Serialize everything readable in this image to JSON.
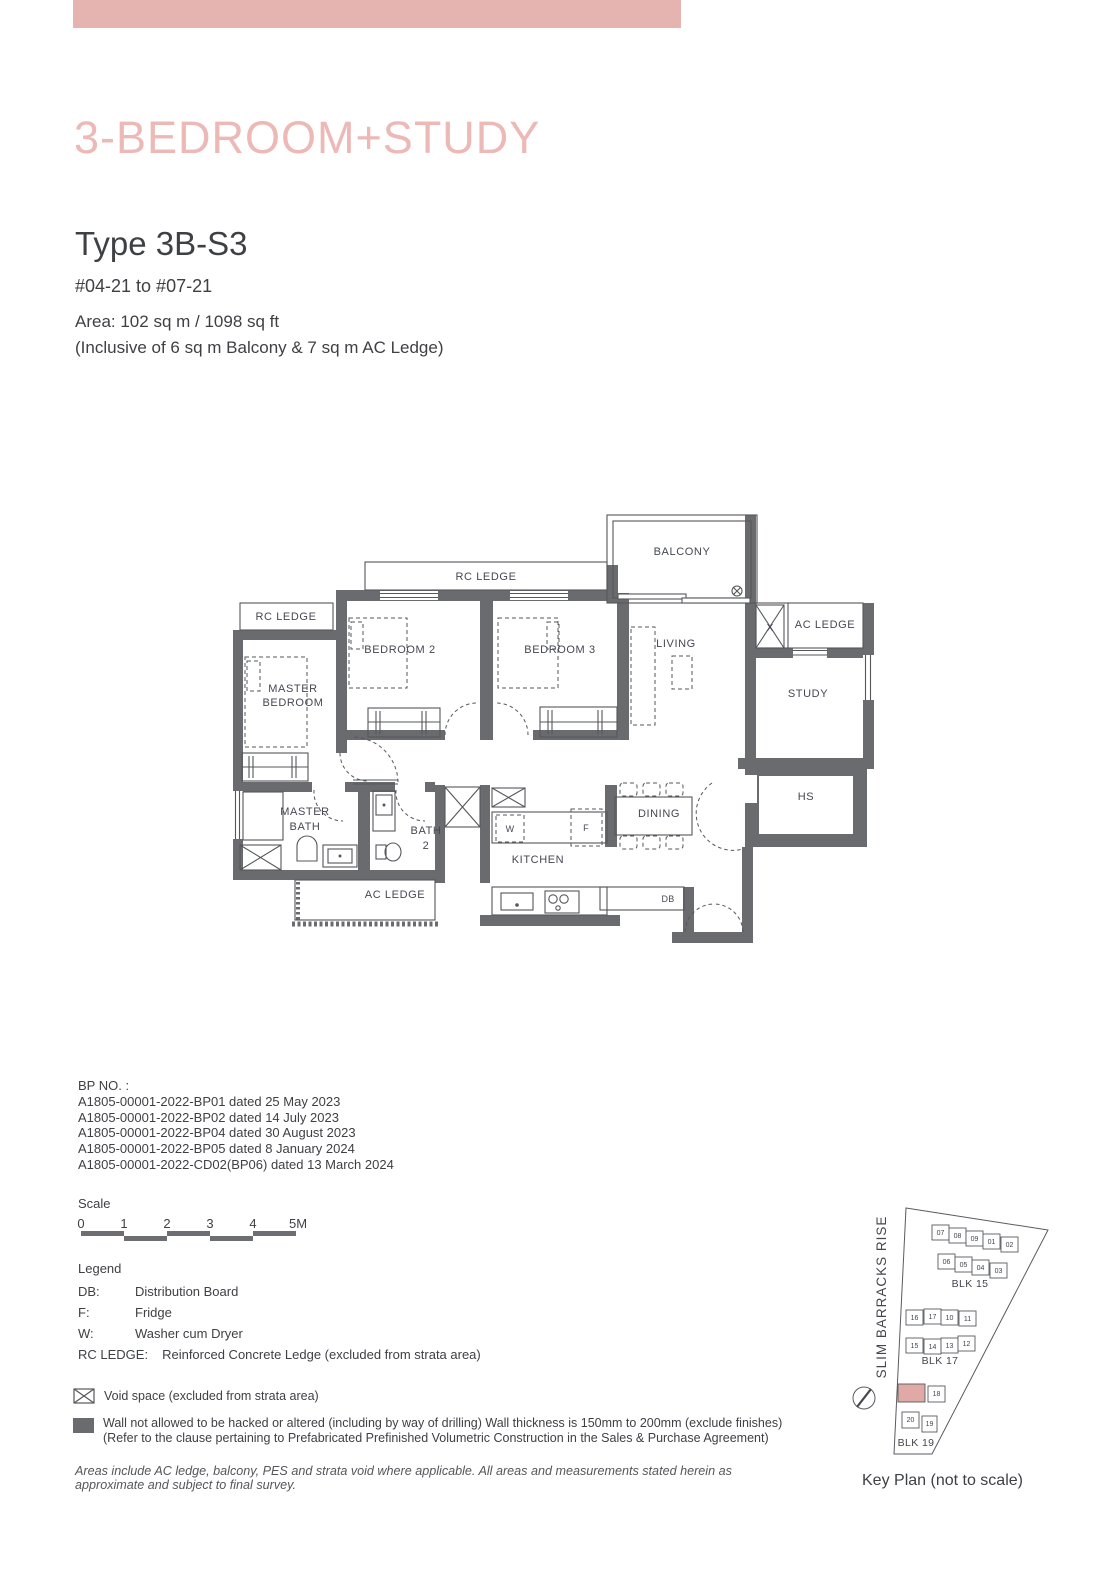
{
  "header": {
    "category_title": "3-BEDROOM+STUDY",
    "type_title": "Type 3B-S3",
    "floor_range": "#04-21 to #07-21",
    "area_line1": "Area: 102 sq m / 1098 sq ft",
    "area_line2": "(Inclusive of 6 sq m Balcony & 7 sq m AC Ledge)"
  },
  "floorplan": {
    "labels": {
      "balcony": "BALCONY",
      "rc_ledge_top": "RC LEDGE",
      "rc_ledge_left": "RC LEDGE",
      "bedroom2": "BEDROOM 2",
      "bedroom3": "BEDROOM 3",
      "living": "LIVING",
      "master_line1": "MASTER",
      "master_line2": "BEDROOM",
      "void_x": "X",
      "ac_ledge_right": "AC LEDGE",
      "study": "STUDY",
      "hs": "HS",
      "dining": "DINING",
      "kitchen": "KITCHEN",
      "master_bath_line1": "MASTER",
      "master_bath_line2": "BATH",
      "bath2_line1": "BATH",
      "bath2_line2": "2",
      "ac_ledge_bottom": "AC LEDGE",
      "db": "DB",
      "washer": "W",
      "fridge": "F"
    }
  },
  "bp": {
    "heading": "BP NO. :",
    "entries": [
      "A1805-00001-2022-BP01 dated 25 May 2023",
      "A1805-00001-2022-BP02 dated 14 July 2023",
      "A1805-00001-2022-BP04 dated 30 August 2023",
      "A1805-00001-2022-BP05 dated 8 January 2024",
      "A1805-00001-2022-CD02(BP06) dated 13 March 2024"
    ]
  },
  "scale": {
    "label": "Scale",
    "ticks": [
      "0",
      "1",
      "2",
      "3",
      "4",
      "5M"
    ]
  },
  "legend": {
    "heading": "Legend",
    "items": [
      {
        "key": "DB:",
        "value": "Distribution Board"
      },
      {
        "key": "F:",
        "value": "Fridge"
      },
      {
        "key": "W:",
        "value": "Washer cum Dryer"
      },
      {
        "key": "RC LEDGE:",
        "value": "Reinforced Concrete Ledge (excluded from strata area)"
      }
    ],
    "void_note": "Void space (excluded from strata area)",
    "wall_note_line1": "Wall not allowed to be hacked or altered (including by way of drilling) Wall thickness is 150mm to 200mm (exclude finishes)",
    "wall_note_line2": "(Refer to the clause pertaining to Prefabricated Prefinished Volumetric Construction in the Sales & Purchase Agreement)"
  },
  "footer_note": "Areas include AC ledge, balcony, PES and strata void where applicable. All areas and measurements stated herein as approximate and subject to final survey.",
  "keyplan": {
    "street": "SLIM BARRACKS RISE",
    "caption": "Key Plan (not to scale)",
    "blk15": {
      "label": "BLK 15",
      "row1": [
        "07",
        "08",
        "09",
        "01",
        "02"
      ],
      "row2": [
        "06",
        "05",
        "04",
        "03"
      ]
    },
    "blk17": {
      "label": "BLK 17",
      "row1": [
        "16",
        "17",
        "10",
        "11"
      ],
      "row2": [
        "15",
        "14",
        "13",
        "12"
      ]
    },
    "blk19": {
      "label": "BLK 19",
      "units": [
        "18",
        "20",
        "19"
      ]
    }
  },
  "colors": {
    "accent_pink_bar": "#E5B3B0",
    "title_pink": "#ECB9B6",
    "wall_gray": "#6A6B6E",
    "keyplan_highlight": "#DFA9A5",
    "text_dark": "#3F4044"
  }
}
